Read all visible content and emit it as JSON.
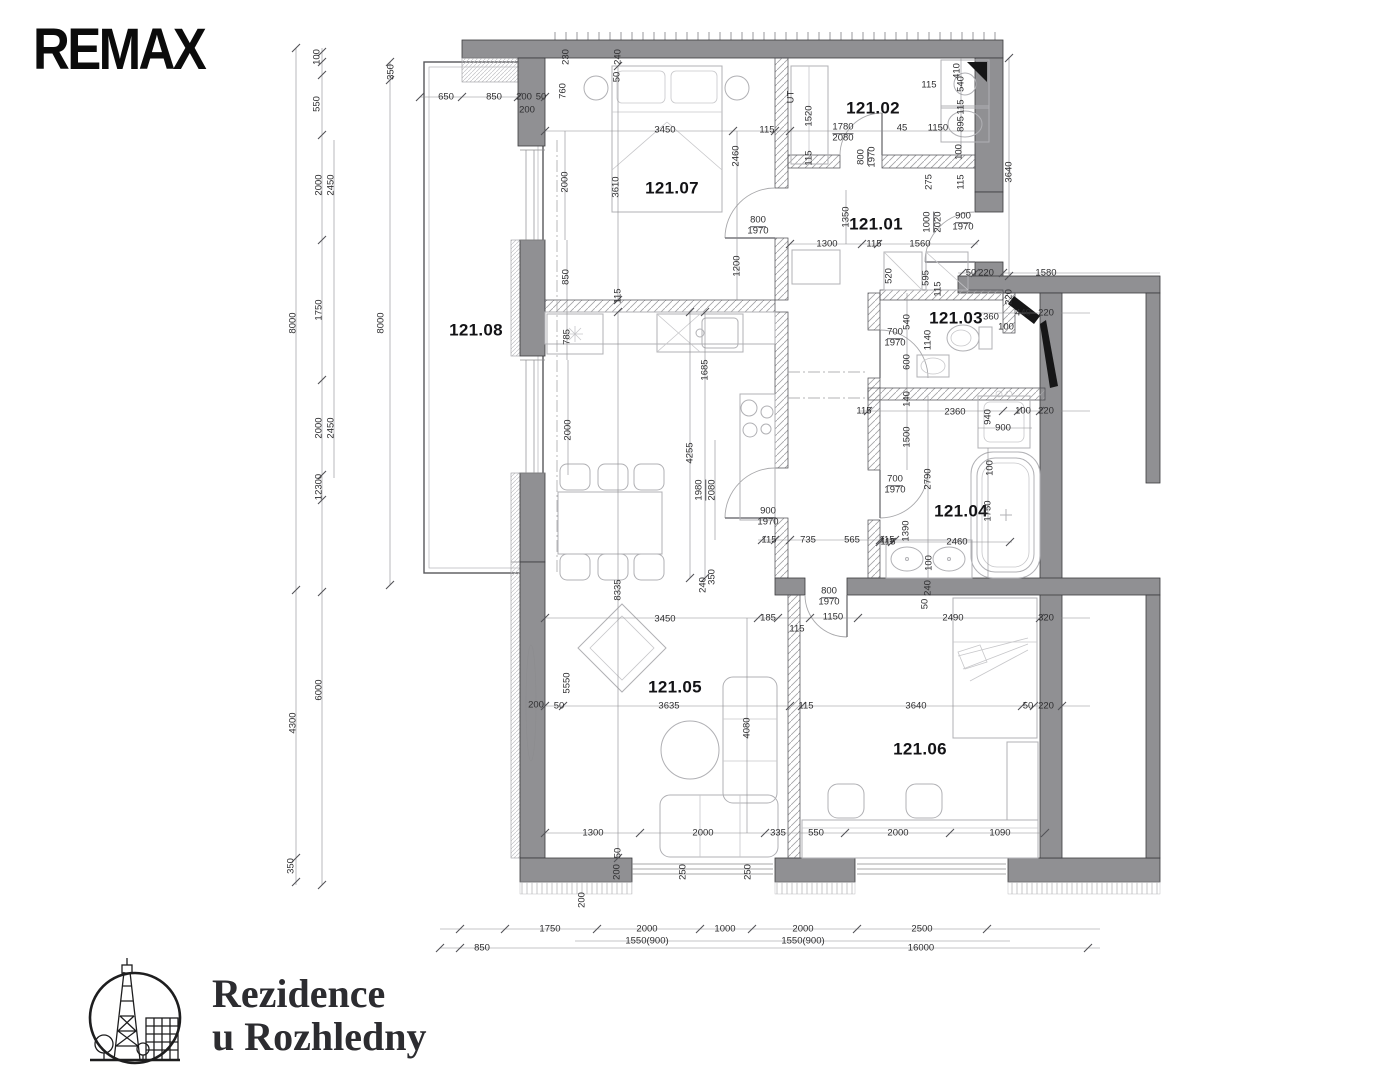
{
  "branding": {
    "remax_text": "REMAX",
    "project_name_line1": "Rezidence",
    "project_name_line2": "u Rozhledny"
  },
  "colors": {
    "wall": "#909093",
    "ink": "#161617"
  },
  "plan": {
    "rooms": [
      {
        "t": "121.07",
        "x": 672,
        "y": 188
      },
      {
        "t": "121.02",
        "x": 873,
        "y": 108
      },
      {
        "t": "121.01",
        "x": 876,
        "y": 224
      },
      {
        "t": "121.03",
        "x": 956,
        "y": 318
      },
      {
        "t": "121.04",
        "x": 961,
        "y": 511
      },
      {
        "t": "121.05",
        "x": 675,
        "y": 687
      },
      {
        "t": "121.06",
        "x": 920,
        "y": 749
      },
      {
        "t": "121.08",
        "x": 476,
        "y": 330
      }
    ],
    "dims": [
      {
        "t": "100",
        "x": 317,
        "y": 57,
        "r": 1
      },
      {
        "t": "550",
        "x": 317,
        "y": 104,
        "r": 1
      },
      {
        "t": "2000",
        "x": 319,
        "y": 185,
        "r": 1
      },
      {
        "t": "2450",
        "x": 331,
        "y": 185,
        "r": 1
      },
      {
        "t": "1750",
        "x": 319,
        "y": 310,
        "r": 1
      },
      {
        "t": "8000",
        "x": 293,
        "y": 323,
        "r": 1
      },
      {
        "t": "2000",
        "x": 319,
        "y": 428,
        "r": 1
      },
      {
        "t": "2450",
        "x": 331,
        "y": 428,
        "r": 1
      },
      {
        "t": "12300",
        "x": 319,
        "y": 487,
        "r": 1
      },
      {
        "t": "6000",
        "x": 319,
        "y": 690,
        "r": 1
      },
      {
        "t": "4300",
        "x": 293,
        "y": 723,
        "r": 1
      },
      {
        "t": "350",
        "x": 291,
        "y": 866,
        "r": 1
      },
      {
        "t": "350",
        "x": 391,
        "y": 72,
        "r": 1
      },
      {
        "t": "8000",
        "x": 381,
        "y": 323,
        "r": 1
      },
      {
        "t": "650",
        "x": 446,
        "y": 97
      },
      {
        "t": "850",
        "x": 494,
        "y": 97
      },
      {
        "t": "200",
        "x": 524,
        "y": 97
      },
      {
        "t": "50",
        "x": 541,
        "y": 97
      },
      {
        "t": "760",
        "x": 563,
        "y": 91,
        "r": 1
      },
      {
        "t": "200",
        "x": 527,
        "y": 110
      },
      {
        "t": "230",
        "x": 566,
        "y": 57,
        "r": 1
      },
      {
        "t": "240",
        "x": 618,
        "y": 57,
        "r": 1
      },
      {
        "t": "50",
        "x": 617,
        "y": 77,
        "r": 1
      },
      {
        "t": "3450",
        "x": 665,
        "y": 130
      },
      {
        "t": "115",
        "x": 767,
        "y": 130
      },
      {
        "t": "2460",
        "x": 736,
        "y": 156,
        "r": 1
      },
      {
        "t": "2000",
        "x": 565,
        "y": 182,
        "r": 1
      },
      {
        "t": "3610",
        "x": 616,
        "y": 187,
        "r": 1
      },
      {
        "t": "800",
        "x": 758,
        "y": 221,
        "u": 1
      },
      {
        "t": "1970",
        "x": 758,
        "y": 231
      },
      {
        "t": "1200",
        "x": 737,
        "y": 266,
        "r": 1
      },
      {
        "t": "850",
        "x": 566,
        "y": 277,
        "r": 1
      },
      {
        "t": "115",
        "x": 618,
        "y": 296,
        "r": 1
      },
      {
        "t": "115",
        "x": 929,
        "y": 85
      },
      {
        "t": "410",
        "x": 957,
        "y": 71,
        "r": 1
      },
      {
        "t": "540",
        "x": 961,
        "y": 84,
        "r": 1
      },
      {
        "t": "1520",
        "x": 809,
        "y": 116,
        "r": 1
      },
      {
        "t": "1780",
        "x": 843,
        "y": 128,
        "u": 1
      },
      {
        "t": "2080",
        "x": 843,
        "y": 138
      },
      {
        "t": "45",
        "x": 902,
        "y": 128
      },
      {
        "t": "1150",
        "x": 938,
        "y": 128
      },
      {
        "t": "115",
        "x": 961,
        "y": 107,
        "r": 1
      },
      {
        "t": "895",
        "x": 961,
        "y": 124,
        "r": 1
      },
      {
        "t": "100",
        "x": 959,
        "y": 152,
        "r": 1
      },
      {
        "t": "3640",
        "x": 1009,
        "y": 172,
        "r": 1
      },
      {
        "t": "115",
        "x": 809,
        "y": 158,
        "r": 1
      },
      {
        "t": "800",
        "x": 862,
        "y": 157,
        "r": 1,
        "u": 1
      },
      {
        "t": "1970",
        "x": 872,
        "y": 157,
        "r": 1
      },
      {
        "t": "UT",
        "x": 791,
        "y": 97,
        "r": 1
      },
      {
        "t": "275",
        "x": 929,
        "y": 182,
        "r": 1
      },
      {
        "t": "115",
        "x": 961,
        "y": 182,
        "r": 1
      },
      {
        "t": "1350",
        "x": 846,
        "y": 217,
        "r": 1
      },
      {
        "t": "1000",
        "x": 928,
        "y": 222,
        "r": 1,
        "u": 1
      },
      {
        "t": "2020",
        "x": 938,
        "y": 222,
        "r": 1
      },
      {
        "t": "900",
        "x": 963,
        "y": 217,
        "u": 1
      },
      {
        "t": "1970",
        "x": 963,
        "y": 227
      },
      {
        "t": "1300",
        "x": 827,
        "y": 244
      },
      {
        "t": "115",
        "x": 874,
        "y": 244
      },
      {
        "t": "1560",
        "x": 920,
        "y": 244
      },
      {
        "t": "50",
        "x": 971,
        "y": 273
      },
      {
        "t": "220",
        "x": 986,
        "y": 273
      },
      {
        "t": "1580",
        "x": 1046,
        "y": 273
      },
      {
        "t": "520",
        "x": 889,
        "y": 276,
        "r": 1
      },
      {
        "t": "595",
        "x": 926,
        "y": 278,
        "r": 1
      },
      {
        "t": "115",
        "x": 938,
        "y": 289,
        "r": 1
      },
      {
        "t": "360",
        "x": 991,
        "y": 317
      },
      {
        "t": "440",
        "x": 1023,
        "y": 313
      },
      {
        "t": "220",
        "x": 1046,
        "y": 313
      },
      {
        "t": "220",
        "x": 1009,
        "y": 297,
        "r": 1
      },
      {
        "t": "100",
        "x": 1006,
        "y": 327
      },
      {
        "t": "540",
        "x": 907,
        "y": 322,
        "r": 1
      },
      {
        "t": "700",
        "x": 895,
        "y": 333,
        "u": 1
      },
      {
        "t": "1970",
        "x": 895,
        "y": 343
      },
      {
        "t": "1140",
        "x": 928,
        "y": 340,
        "r": 1
      },
      {
        "t": "600",
        "x": 907,
        "y": 362,
        "r": 1
      },
      {
        "t": "140",
        "x": 907,
        "y": 399,
        "r": 1
      },
      {
        "t": "115",
        "x": 864,
        "y": 411
      },
      {
        "t": "2360",
        "x": 955,
        "y": 412
      },
      {
        "t": "940",
        "x": 988,
        "y": 417,
        "r": 1
      },
      {
        "t": "900",
        "x": 1003,
        "y": 428
      },
      {
        "t": "100",
        "x": 1023,
        "y": 411
      },
      {
        "t": "220",
        "x": 1046,
        "y": 411
      },
      {
        "t": "1500",
        "x": 907,
        "y": 437,
        "r": 1
      },
      {
        "t": "700",
        "x": 895,
        "y": 480,
        "u": 1
      },
      {
        "t": "1970",
        "x": 895,
        "y": 490
      },
      {
        "t": "2790",
        "x": 928,
        "y": 479,
        "r": 1
      },
      {
        "t": "100",
        "x": 990,
        "y": 468,
        "r": 1
      },
      {
        "t": "1750",
        "x": 988,
        "y": 511,
        "r": 1
      },
      {
        "t": "1390",
        "x": 906,
        "y": 531,
        "r": 1
      },
      {
        "t": "115",
        "x": 888,
        "y": 542
      },
      {
        "t": "2460",
        "x": 957,
        "y": 542
      },
      {
        "t": "100",
        "x": 929,
        "y": 563,
        "r": 1
      },
      {
        "t": "240",
        "x": 928,
        "y": 588,
        "r": 1
      },
      {
        "t": "50",
        "x": 925,
        "y": 604,
        "r": 1
      },
      {
        "t": "2490",
        "x": 953,
        "y": 618
      },
      {
        "t": "320",
        "x": 1046,
        "y": 618
      },
      {
        "t": "785",
        "x": 567,
        "y": 337,
        "r": 1
      },
      {
        "t": "1685",
        "x": 705,
        "y": 370,
        "r": 1
      },
      {
        "t": "2000",
        "x": 568,
        "y": 430,
        "r": 1
      },
      {
        "t": "4255",
        "x": 690,
        "y": 453,
        "r": 1
      },
      {
        "t": "1980",
        "x": 700,
        "y": 490,
        "r": 1,
        "u": 1
      },
      {
        "t": "2080",
        "x": 712,
        "y": 490,
        "r": 1
      },
      {
        "t": "900",
        "x": 768,
        "y": 512,
        "u": 1
      },
      {
        "t": "1970",
        "x": 768,
        "y": 522
      },
      {
        "t": "115",
        "x": 769,
        "y": 540
      },
      {
        "t": "735",
        "x": 808,
        "y": 540
      },
      {
        "t": "565",
        "x": 852,
        "y": 540
      },
      {
        "t": "115",
        "x": 887,
        "y": 540
      },
      {
        "t": "8335",
        "x": 618,
        "y": 590,
        "r": 1
      },
      {
        "t": "240",
        "x": 703,
        "y": 585,
        "r": 1
      },
      {
        "t": "350",
        "x": 712,
        "y": 577,
        "r": 1
      },
      {
        "t": "800",
        "x": 829,
        "y": 592,
        "u": 1
      },
      {
        "t": "1970",
        "x": 829,
        "y": 602
      },
      {
        "t": "185",
        "x": 768,
        "y": 618
      },
      {
        "t": "1150",
        "x": 833,
        "y": 617
      },
      {
        "t": "3450",
        "x": 665,
        "y": 619
      },
      {
        "t": "115",
        "x": 797,
        "y": 629
      },
      {
        "t": "5550",
        "x": 567,
        "y": 683,
        "r": 1
      },
      {
        "t": "200",
        "x": 536,
        "y": 705
      },
      {
        "t": "50",
        "x": 559,
        "y": 706
      },
      {
        "t": "3635",
        "x": 669,
        "y": 706
      },
      {
        "t": "4080",
        "x": 747,
        "y": 728,
        "r": 1
      },
      {
        "t": "115",
        "x": 806,
        "y": 706
      },
      {
        "t": "3640",
        "x": 916,
        "y": 706
      },
      {
        "t": "50",
        "x": 1028,
        "y": 706
      },
      {
        "t": "220",
        "x": 1046,
        "y": 706
      },
      {
        "t": "1300",
        "x": 593,
        "y": 833
      },
      {
        "t": "2000",
        "x": 703,
        "y": 833
      },
      {
        "t": "335",
        "x": 778,
        "y": 833
      },
      {
        "t": "550",
        "x": 816,
        "y": 833
      },
      {
        "t": "2000",
        "x": 898,
        "y": 833
      },
      {
        "t": "1090",
        "x": 1000,
        "y": 833
      },
      {
        "t": "50",
        "x": 618,
        "y": 853,
        "r": 1
      },
      {
        "t": "200",
        "x": 617,
        "y": 872,
        "r": 1
      },
      {
        "t": "250",
        "x": 683,
        "y": 872,
        "r": 1
      },
      {
        "t": "250",
        "x": 748,
        "y": 872,
        "r": 1
      },
      {
        "t": "200",
        "x": 582,
        "y": 900,
        "r": 1
      },
      {
        "t": "1750",
        "x": 550,
        "y": 929
      },
      {
        "t": "2000",
        "x": 647,
        "y": 929
      },
      {
        "t": "1000",
        "x": 725,
        "y": 929
      },
      {
        "t": "2000",
        "x": 803,
        "y": 929
      },
      {
        "t": "2500",
        "x": 922,
        "y": 929
      },
      {
        "t": "1550(900)",
        "x": 647,
        "y": 941
      },
      {
        "t": "1550(900)",
        "x": 803,
        "y": 941
      },
      {
        "t": "850",
        "x": 482,
        "y": 948
      },
      {
        "t": "16000",
        "x": 921,
        "y": 948
      }
    ]
  }
}
